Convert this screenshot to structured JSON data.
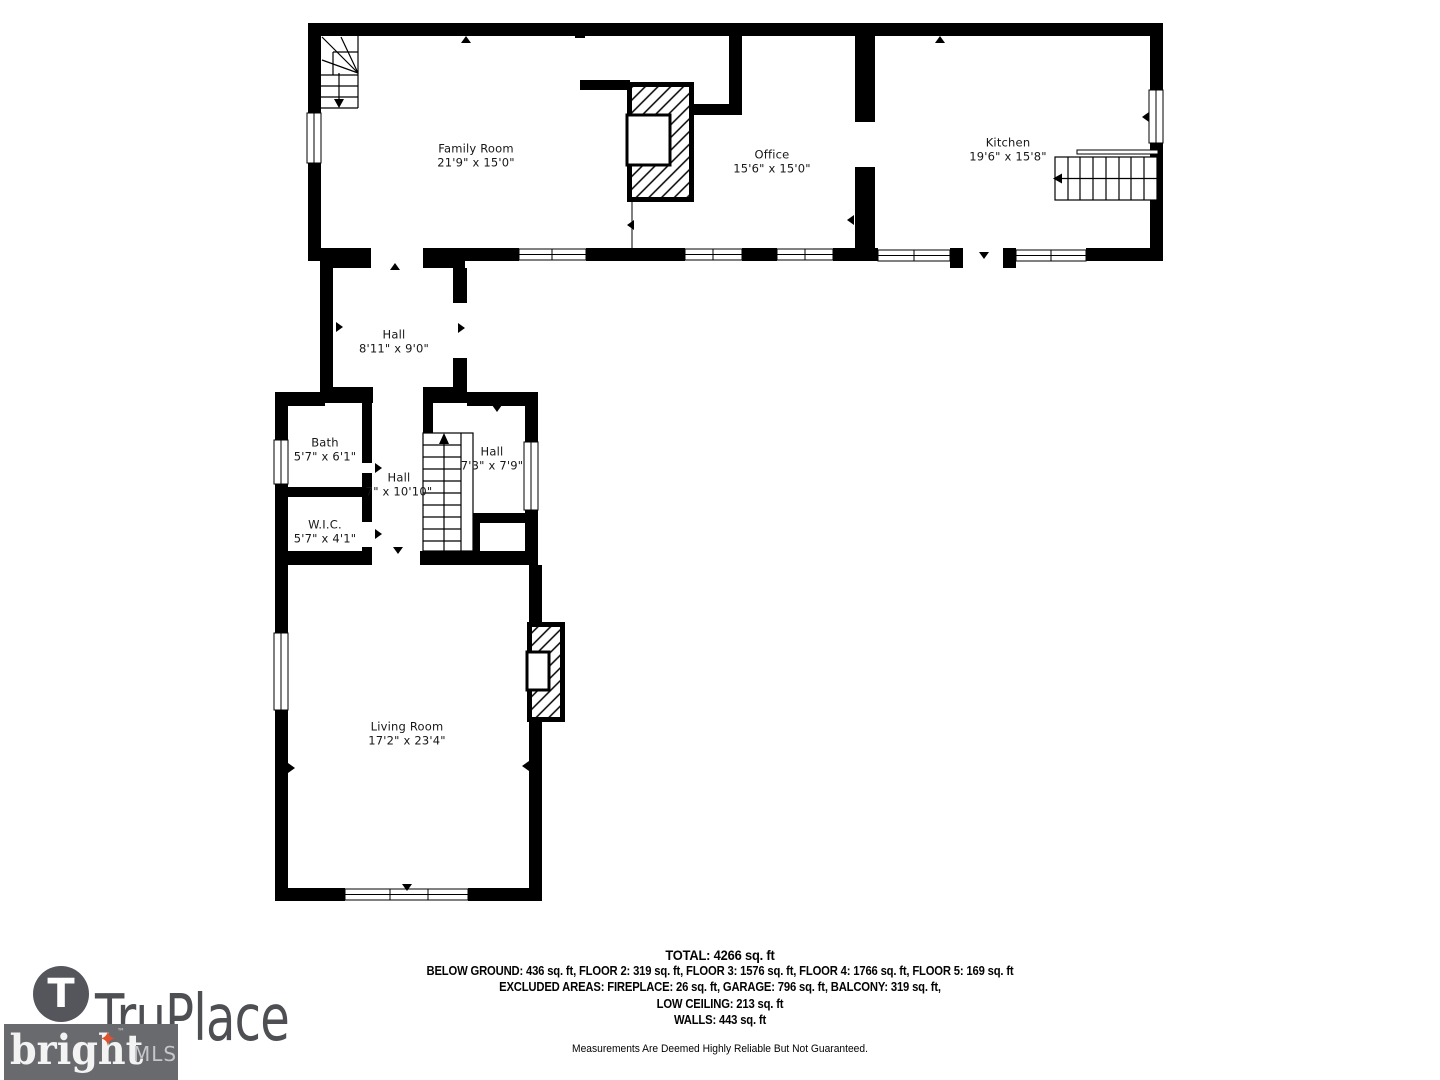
{
  "floor_plan": {
    "rooms": [
      {
        "id": "family-room",
        "name": "Family Room",
        "dims": "21'9\" x 15'0\""
      },
      {
        "id": "office",
        "name": "Office",
        "dims": "15'6\" x 15'0\""
      },
      {
        "id": "kitchen",
        "name": "Kitchen",
        "dims": "19'6\" x 15'8\""
      },
      {
        "id": "hall-upper",
        "name": "Hall",
        "dims": "8'11\" x 9'0\""
      },
      {
        "id": "bath",
        "name": "Bath",
        "dims": "5'7\" x 6'1\""
      },
      {
        "id": "hall-middle",
        "name": "Hall",
        "dims": "7\" x 10'10\""
      },
      {
        "id": "hall-stairs",
        "name": "Hall",
        "dims": "7'3\" x 7'9\""
      },
      {
        "id": "wic",
        "name": "W.I.C.",
        "dims": "5'7\" x 4'1\""
      },
      {
        "id": "living-room",
        "name": "Living Room",
        "dims": "17'2\" x 23'4\""
      }
    ]
  },
  "summary": {
    "total": "TOTAL: 4266 sq. ft",
    "floors": "BELOW GROUND: 436 sq. ft, FLOOR 2: 319 sq. ft, FLOOR 3: 1576 sq. ft, FLOOR 4: 1766 sq. ft, FLOOR 5: 169 sq. ft",
    "excluded": "EXCLUDED AREAS: FIREPLACE: 26 sq. ft, GARAGE: 796 sq. ft, BALCONY: 319 sq. ft,",
    "low_ceiling": "LOW CEILING: 213 sq. ft",
    "walls": "WALLS: 443 sq. ft",
    "disclaimer": "Measurements Are Deemed Highly Reliable But Not Guaranteed."
  },
  "branding": {
    "truplace": {
      "monogram": "T",
      "wordmark": "TruPlace"
    },
    "bright_mls": {
      "wordmark": "bright",
      "tm": "™",
      "suffix": "MLS"
    }
  },
  "colors": {
    "walls": "#000000",
    "background": "#ffffff",
    "truplace_gray": "#4d4f53",
    "bright_box_gray": "#696a6e",
    "bright_star_orange": "#e0512c"
  }
}
